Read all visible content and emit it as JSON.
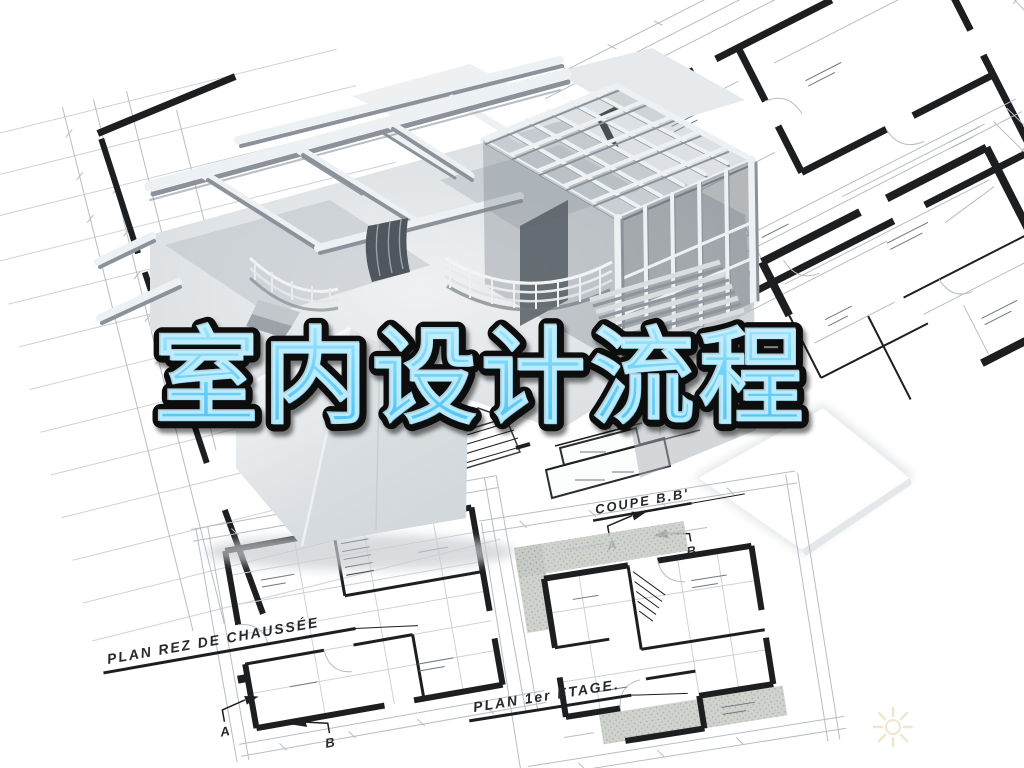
{
  "image": {
    "kind": "architectural-promo-still",
    "subject": "3D cutaway house model standing on scattered blueprint floor plans"
  },
  "title": {
    "text": "室内设计流程",
    "fill_top": "#9fe3fb",
    "fill_bottom": "#55c3f2",
    "outline": "#0a0a0a"
  },
  "blueprints": {
    "plan_ground_label": "PLAN REZ DE CHAUSSÉE",
    "plan_first_label": "PLAN 1er ETAGE.",
    "section_label": "COUPE B.B'",
    "marker_a": "A",
    "marker_b": "B"
  },
  "watermark": {
    "name": "sun-burst",
    "color": "#ece0bf"
  },
  "palette": {
    "paper": "#ffffff",
    "blueprint_line": "#b7bdc4",
    "wall_ink": "#1c1e20",
    "model_light": "#f2f4f5",
    "model_mid": "#b3b9bf",
    "model_dark": "#8f969d"
  }
}
